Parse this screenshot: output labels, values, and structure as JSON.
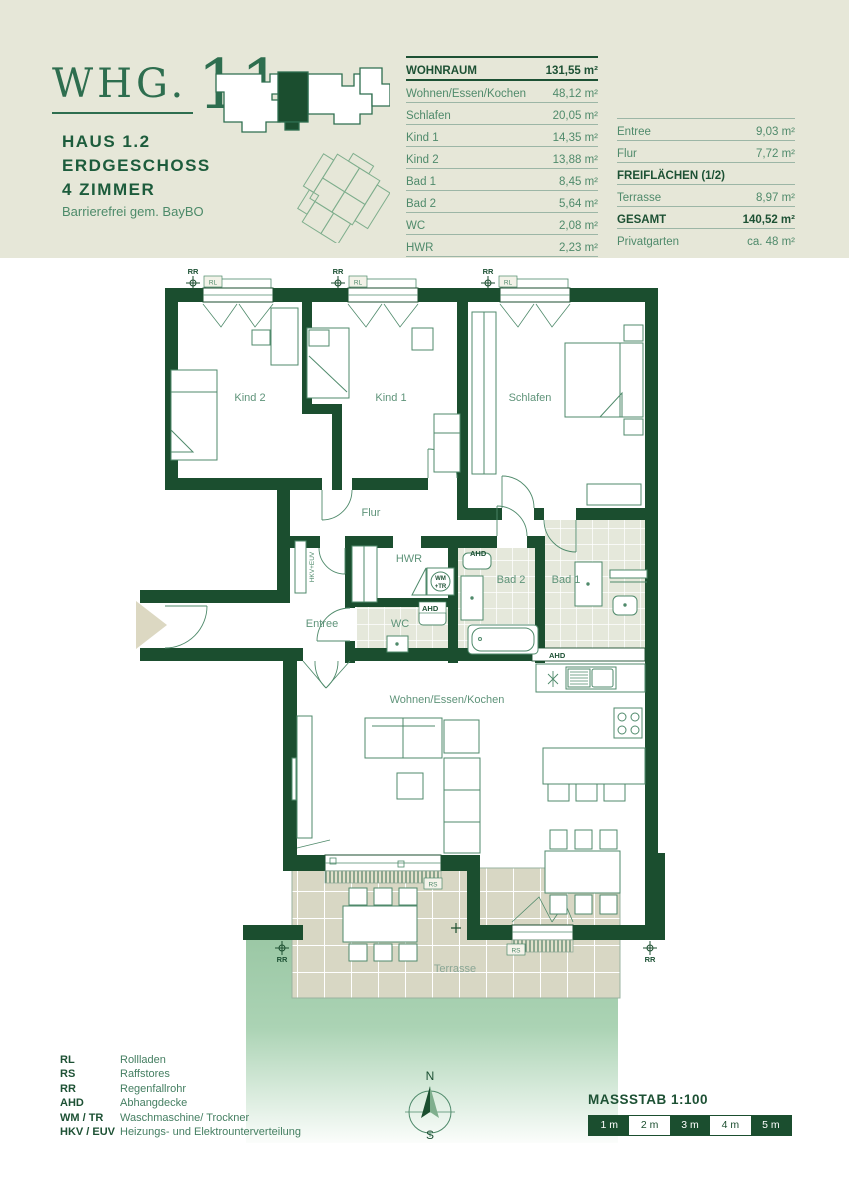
{
  "header": {
    "unit_prefix": "WHG.",
    "unit_number": "11",
    "house": "HAUS 1.2",
    "floor": "ERDGESCHOSS",
    "rooms_line": "4 ZIMMER",
    "note": "Barrierefrei gem. BayBO"
  },
  "area_table": {
    "header_label": "WOHNRAUM",
    "header_value": "131,55 m²",
    "rows": [
      {
        "label": "Wohnen/Essen/Kochen",
        "value": "48,12 m²"
      },
      {
        "label": "Schlafen",
        "value": "20,05 m²"
      },
      {
        "label": "Kind 1",
        "value": "14,35 m²"
      },
      {
        "label": "Kind 2",
        "value": "13,88 m²"
      },
      {
        "label": "Bad 1",
        "value": "8,45 m²"
      },
      {
        "label": "Bad 2",
        "value": "5,64 m²"
      },
      {
        "label": "WC",
        "value": "2,08 m²"
      },
      {
        "label": "HWR",
        "value": "2,23 m²"
      }
    ]
  },
  "summary_table": {
    "rows": [
      {
        "label": "Entree",
        "value": "9,03 m²"
      },
      {
        "label": "Flur",
        "value": "7,72 m²"
      },
      {
        "label": "FREIFLÄCHEN (1/2)",
        "value": ""
      },
      {
        "label": "Terrasse",
        "value": "8,97 m²"
      },
      {
        "label": "GESAMT",
        "value": "140,52 m²"
      },
      {
        "label": "Privatgarten",
        "value": "ca. 48 m²"
      }
    ]
  },
  "plan": {
    "rooms": {
      "kind2": "Kind 2",
      "kind1": "Kind 1",
      "schlafen": "Schlafen",
      "flur": "Flur",
      "hwr": "HWR",
      "bad2": "Bad 2",
      "bad1": "Bad 1",
      "entree": "Entree",
      "wc": "WC",
      "wohnen": "Wohnen/Essen/Kochen",
      "terrasse": "Terrasse"
    },
    "markers": {
      "rr": "RR",
      "rl": "RL",
      "rs": "RS",
      "ahd": "AHD",
      "wm": "WM",
      "tr": "+TR",
      "hkv": "HKV+EUV"
    }
  },
  "legend": {
    "items": [
      {
        "abbr": "RL",
        "desc": "Rollladen"
      },
      {
        "abbr": "RS",
        "desc": "Raffstores"
      },
      {
        "abbr": "RR",
        "desc": "Regenfallrohr"
      },
      {
        "abbr": "AHD",
        "desc": "Abhangdecke"
      },
      {
        "abbr": "WM / TR",
        "desc": "Waschmaschine/ Trockner"
      },
      {
        "abbr": "HKV / EUV",
        "desc": "Heizungs- und Elektrounterverteilung"
      }
    ]
  },
  "compass": {
    "north": "N",
    "south": "S"
  },
  "scale": {
    "title": "MASSSTAB 1:100",
    "segments": [
      "1 m",
      "2 m",
      "3 m",
      "4 m",
      "5 m"
    ]
  }
}
